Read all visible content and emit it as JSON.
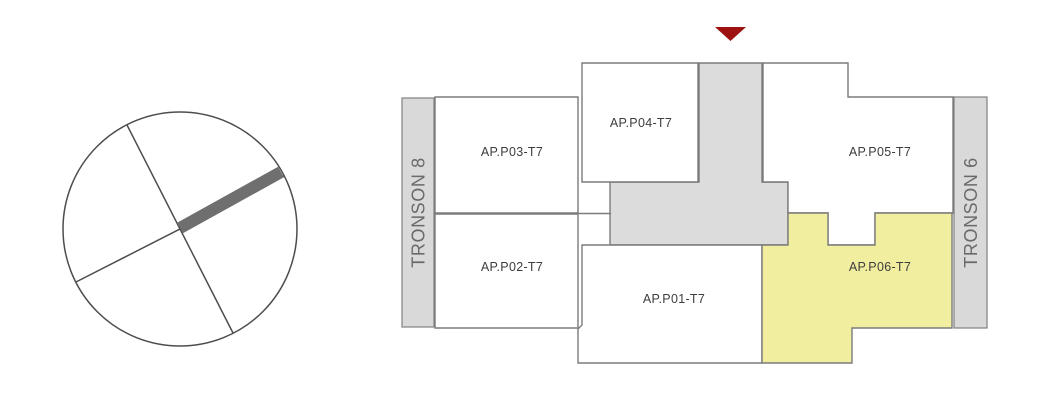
{
  "colors": {
    "room-fill": "#ffffff",
    "room-outline": "#7b7b7b",
    "highlight-fill": "#f2ee9f",
    "corridor-fill": "#dcdcdc",
    "wing-fill": "#d9d9d9",
    "wing-outline": "#808080",
    "label-color": "#3d3d3d",
    "wing-label-color": "#6a6a6a",
    "marker-color": "#9e1111",
    "compass-stroke": "#4d4d4d",
    "needle-fill": "#6f6f6f"
  },
  "plan": {
    "wings": [
      {
        "label": "TRONSON 8"
      },
      {
        "label": "TRONSON 6"
      }
    ],
    "apartments": [
      {
        "label": "AP.P01-T7",
        "highlighted": false
      },
      {
        "label": "AP.P02-T7",
        "highlighted": false
      },
      {
        "label": "AP.P03-T7",
        "highlighted": false
      },
      {
        "label": "AP.P04-T7",
        "highlighted": false
      },
      {
        "label": "AP.P05-T7",
        "highlighted": false
      },
      {
        "label": "AP.P06-T7",
        "highlighted": true
      }
    ]
  }
}
